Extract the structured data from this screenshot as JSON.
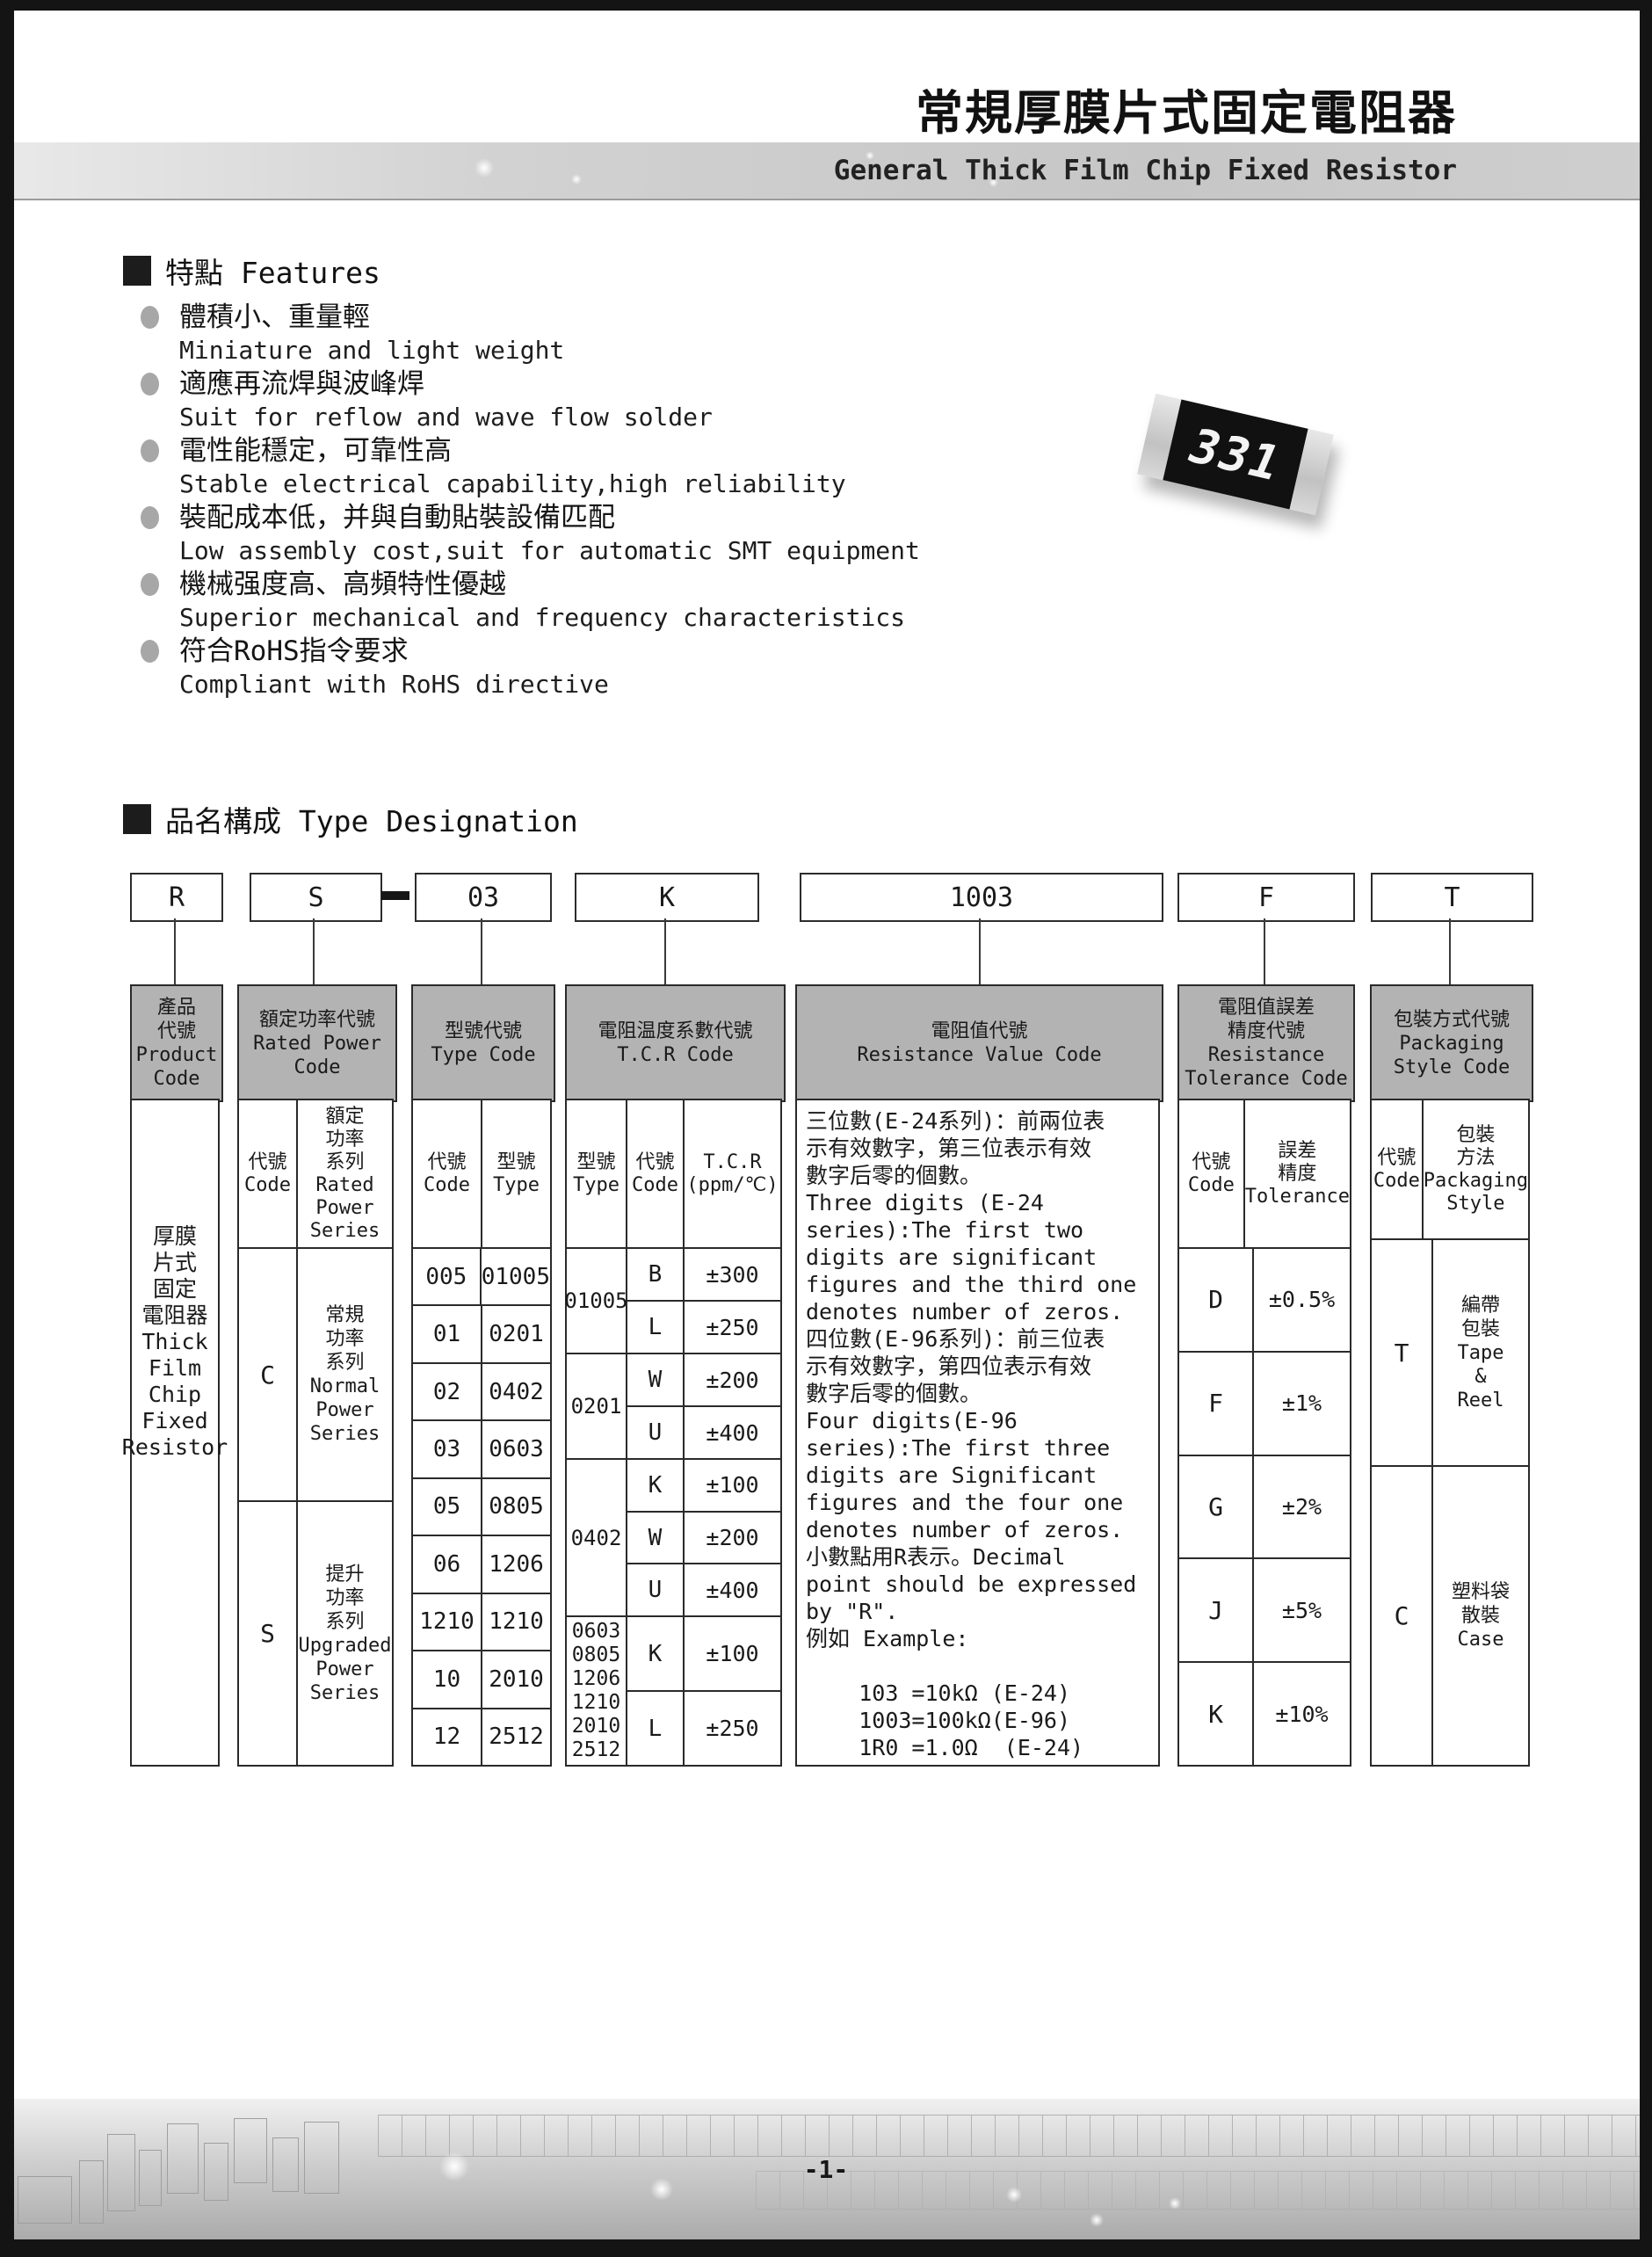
{
  "header": {
    "title_zh": "常規厚膜片式固定電阻器",
    "title_en": "General Thick Film Chip Fixed Resistor"
  },
  "features": {
    "heading": "特點 Features",
    "items": [
      {
        "zh": "體積小、重量輕",
        "en": "Miniature and light weight"
      },
      {
        "zh": "適應再流焊與波峰焊",
        "en": "Suit for reflow and wave flow solder"
      },
      {
        "zh": "電性能穩定，可靠性高",
        "en": "Stable electrical capability,high reliability"
      },
      {
        "zh": "裝配成本低，并與自動貼裝設備匹配",
        "en": "Low assembly cost,suit for automatic SMT equipment"
      },
      {
        "zh": "機械强度高、高頻特性優越",
        "en": "Superior mechanical and frequency characteristics"
      },
      {
        "zh": "符合RoHS指令要求",
        "en": "Compliant with RoHS directive"
      }
    ]
  },
  "chip": {
    "marking": "331"
  },
  "designation": {
    "heading": "品名構成  Type Designation",
    "boxes": [
      "R",
      "S",
      "03",
      "K",
      "1003",
      "F",
      "T"
    ]
  },
  "table": {
    "product": {
      "header": "產品\n代號\nProduct\nCode",
      "body": "厚膜\n片式\n固定\n電阻器\nThick\nFilm\nChip\nFixed\nResistor"
    },
    "power": {
      "header": "額定功率代號\nRated Power\nCode",
      "sub_code": "代號\nCode",
      "sub_series": "額定\n功率\n系列\nRated\nPower\nSeries",
      "rows": [
        {
          "code": "C",
          "series": "常規\n功率\n系列\nNormal\nPower\nSeries"
        },
        {
          "code": "S",
          "series": "提升\n功率\n系列\nUpgraded\nPower\nSeries"
        }
      ]
    },
    "type": {
      "header": "型號代號\nType Code",
      "sub_code": "代號\nCode",
      "sub_type": "型號\nType",
      "rows": [
        [
          "005",
          "01005"
        ],
        [
          "01",
          "0201"
        ],
        [
          "02",
          "0402"
        ],
        [
          "03",
          "0603"
        ],
        [
          "05",
          "0805"
        ],
        [
          "06",
          "1206"
        ],
        [
          "1210",
          "1210"
        ],
        [
          "10",
          "2010"
        ],
        [
          "12",
          "2512"
        ]
      ]
    },
    "tcr": {
      "header": "電阻温度系數代號\nT.C.R Code",
      "sub_type": "型號\nType",
      "sub_code": "代號\nCode",
      "sub_val": "T.C.R\n(ppm/℃)",
      "groups": [
        {
          "type": "01005",
          "rows": [
            [
              "B",
              "±300"
            ],
            [
              "L",
              "±250"
            ]
          ]
        },
        {
          "type": "0201",
          "rows": [
            [
              "W",
              "±200"
            ],
            [
              "U",
              "±400"
            ]
          ]
        },
        {
          "type": "0402",
          "rows": [
            [
              "K",
              "±100"
            ],
            [
              "W",
              "±200"
            ],
            [
              "U",
              "±400"
            ]
          ]
        },
        {
          "type": "0603\n0805\n1206\n1210\n2010\n2512",
          "rows": [
            [
              "K",
              "±100"
            ],
            [
              "L",
              "±250"
            ]
          ]
        }
      ]
    },
    "resistance": {
      "header": "電阻值代號\nResistance Value Code",
      "body": "三位數(E-24系列)：前兩位表\n示有效數字，第三位表示有效\n數字后零的個數。\nThree digits (E-24\nseries):The first two\ndigits are significant\nfigures and the third one\ndenotes number of zeros.\n四位數(E-96系列)：前三位表\n示有效數字，第四位表示有效\n數字后零的個數。\nFour digits(E-96\nseries):The first three\ndigits are Significant\nfigures and the four one\ndenotes number of zeros.\n小數點用R表示。Decimal\npoint should be expressed\nby \"R\".\n例如 Example:\n\n    103 =10kΩ (E-24)\n    1003=100kΩ(E-96)\n    1R0 =1.0Ω  (E-24)"
    },
    "tolerance": {
      "header": "電阻值誤差\n精度代號\nResistance\nTolerance Code",
      "sub_code": "代號\nCode",
      "sub_tol": "誤差\n精度\nTolerance",
      "rows": [
        [
          "D",
          "±0.5%"
        ],
        [
          "F",
          "±1%"
        ],
        [
          "G",
          "±2%"
        ],
        [
          "J",
          "±5%"
        ],
        [
          "K",
          "±10%"
        ]
      ]
    },
    "packaging": {
      "header": "包裝方式代號\nPackaging\nStyle Code",
      "sub_code": "代號\nCode",
      "sub_style": "包裝\n方法\nPackaging\nStyle",
      "rows": [
        {
          "code": "T",
          "style": "編帶\n包裝\nTape\n&\nReel"
        },
        {
          "code": "C",
          "style": "塑料袋\n散裝\nCase"
        }
      ]
    }
  },
  "footer": {
    "page_number": "-1-"
  }
}
